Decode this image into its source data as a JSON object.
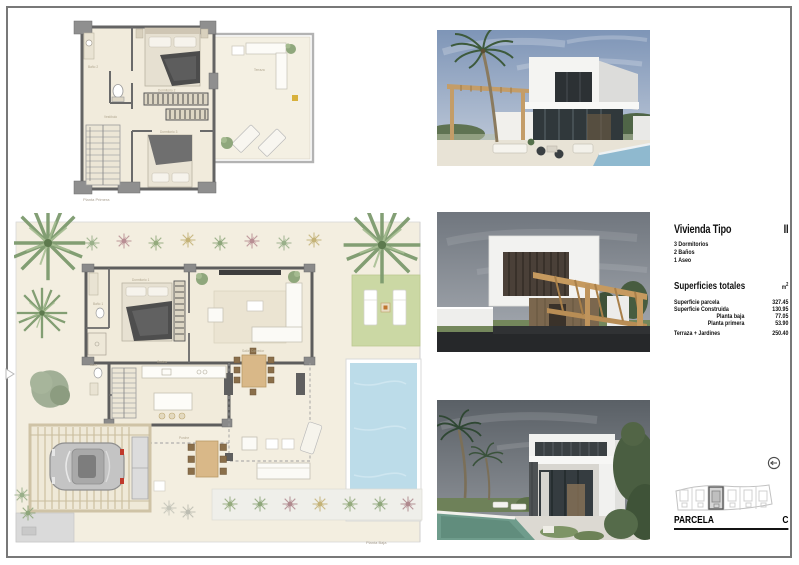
{
  "colors": {
    "frame": "#787878",
    "plan_floor": "#f1ebdc",
    "wall": "#5f5f5f",
    "pool": "#bcdce9",
    "lawn": "#cbd8a4",
    "wood": "#c69a5f",
    "text": "#111111"
  },
  "plans": {
    "first_floor": {
      "label": "Planta Primera",
      "rooms": {
        "bath": "Baño 2",
        "bedroom2": "Dormitorio 2",
        "hall": "Vestíbulo",
        "bedroom3": "Dormitorio 3",
        "terrace": "Terraza"
      }
    },
    "ground_floor": {
      "label": "Planta Baja",
      "rooms": {
        "bedroom1": "Dormitorio 1",
        "bath": "Baño 1",
        "living": "Salón Comedor",
        "kitchen": "Cocina",
        "toilet": "Aseo",
        "porch": "Porche"
      }
    }
  },
  "info": {
    "title": "Vivienda Tipo",
    "type_number": "II",
    "features": [
      "3 Dormitorios",
      "2 Baños",
      "1 Aseo"
    ],
    "totals_title": "Superficies totales",
    "unit": "m",
    "unit_sup": "2",
    "rows": [
      {
        "label": "Superficie parcela",
        "value": "327.45"
      },
      {
        "label": "Superficie Construida",
        "value": "130.95"
      },
      {
        "label": "Planta baja",
        "value": "77.05"
      },
      {
        "label": "Planta primera",
        "value": "53.90"
      },
      {
        "label": "Terraza + Jardines",
        "value": "250.40"
      }
    ],
    "parcel_label": "PARCELA",
    "parcel_letter": "C"
  }
}
